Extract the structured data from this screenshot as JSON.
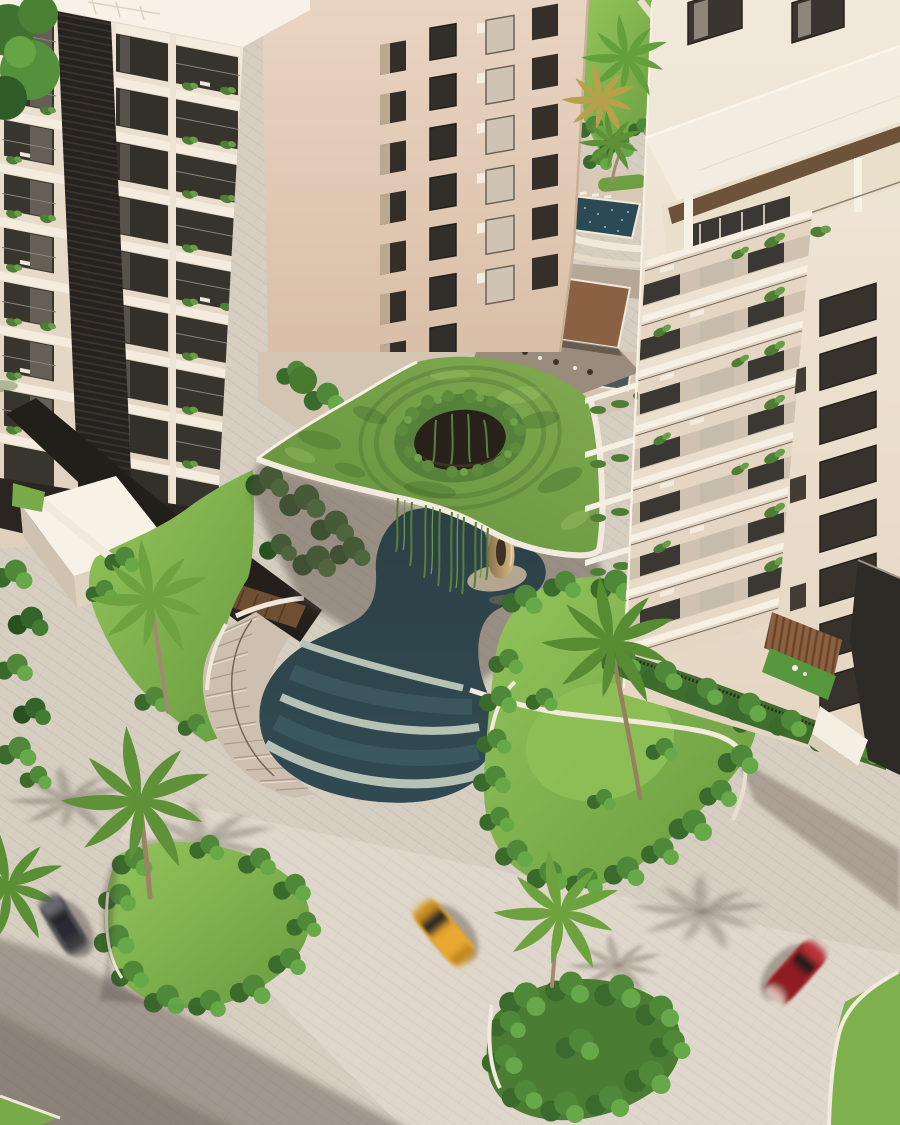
{
  "meta": {
    "kind": "aerial-architectural-render",
    "subject": "residential-complex-with-green-roof-canopy-pool-and-landscaped-roads",
    "width": 900,
    "height": 1125
  },
  "palette": {
    "pavement": "#d7cec2",
    "pavement_shadow": "rgba(88,74,64,0.42)",
    "canopy_grass": "#6f9c44",
    "lawn_bright": "#8fc157",
    "hedge": "#3f6f2e",
    "pool_water": "#2e4348",
    "pool_step": "#b7c2b6",
    "curb_white": "#f2eadd",
    "building_cream": "#e9decf",
    "building_beige": "#e6d1bf",
    "building_white": "#efe5d6",
    "window_dark": "#35302a",
    "wood_pergola": "#8a6142",
    "fence_dark": "#2e2a25",
    "sculpture_bronze": "#c9ad7c",
    "car_grey": "#4e4d52",
    "car_yellow": "#e2a02b",
    "car_red": "#a02028",
    "palm_green": "#6da23f",
    "palm_gold": "#b9a14c"
  },
  "scene": {
    "buildings": [
      {
        "id": "left-tower",
        "floors_visible": 9,
        "feature": "balconies-with-planters-and-dark-louver-core"
      },
      {
        "id": "middle-tower",
        "floors_visible": 7,
        "feature": "flat-facade-window-grid-entrance-pergola"
      },
      {
        "id": "right-tower",
        "floors_visible": 8,
        "feature": "terraced-balconies-penthouse-roof-deck"
      }
    ],
    "features": [
      "organic-green-roof-canopy-with-circular-vine-oculus",
      "hanging-vines",
      "freeform-dark-pool-with-bronze-sculpture",
      "three-cascading-water-terraces",
      "curved-concrete-stairs",
      "amenity-deck-with-small-pool-and-loungers",
      "landscaped-islands-with-white-curbs",
      "paver-roads-with-long-shadows"
    ],
    "palm_trees_count": 8,
    "cars": [
      {
        "id": "grey-car",
        "color": "#4e4d52",
        "position": "left-road",
        "motion": "blurred"
      },
      {
        "id": "yellow-car",
        "color": "#e2a02b",
        "position": "center-road",
        "motion": "blurred"
      },
      {
        "id": "red-car",
        "color": "#a02028",
        "position": "right-road",
        "motion": "blurred"
      }
    ]
  }
}
